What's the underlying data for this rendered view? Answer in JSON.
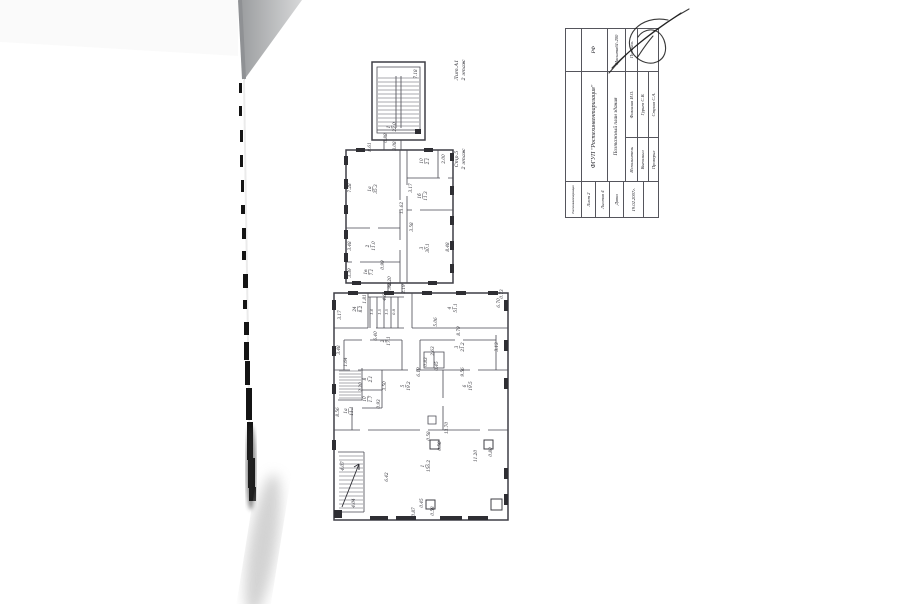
{
  "colors": {
    "wall": "#3f3f46",
    "ink": "#2c2c33",
    "paper": "#ffffff",
    "corner_shadow": "#c2c4c6"
  },
  "titleblock": {
    "org_small": "Ростехинвентаризация",
    "org": "ФГУП \"Ростехинвентаризация\"",
    "doc_title": "Поэтажный план здания",
    "rf": "РФ",
    "scale_label": "Масштаб",
    "scale_value": "1:200",
    "sign_label": "Подпись",
    "sheet": "Лист 2",
    "sheets": "Листов 4",
    "date_label": "Дата",
    "date_value": "19.02.2007г.",
    "col_role": "Исполнитель",
    "col_name": "Фамилия И.О.",
    "rows": [
      {
        "role": "Выполнил",
        "name": "Гурьев С.В."
      },
      {
        "role": "Проверил",
        "name": "Стуков С.А."
      }
    ]
  },
  "plan": {
    "texts": [
      {
        "t": "Лит.А1",
        "x": 458,
        "y": 70,
        "s": 5,
        "n": "section-label"
      },
      {
        "t": "2 этаж",
        "x": 465,
        "y": 70,
        "s": 5,
        "n": "section-label"
      },
      {
        "t": "Стр.5",
        "x": 458,
        "y": 159,
        "s": 5,
        "n": "section-label"
      },
      {
        "t": "2 этаж",
        "x": 465,
        "y": 159,
        "s": 5,
        "n": "section-label"
      },
      {
        "t": "7.18",
        "x": 417,
        "y": 74
      },
      {
        "t": "1",
        "x": 390,
        "y": 127,
        "u": 1
      },
      {
        "t": "22.0",
        "x": 396,
        "y": 127
      },
      {
        "t": "0.88",
        "x": 387,
        "y": 138
      },
      {
        "t": "3.08",
        "x": 396,
        "y": 146
      },
      {
        "t": "8.61",
        "x": 371,
        "y": 147
      },
      {
        "t": "1а",
        "x": 371,
        "y": 189,
        "u": 1
      },
      {
        "t": "35.3",
        "x": 377,
        "y": 189
      },
      {
        "t": "7.28",
        "x": 351,
        "y": 188
      },
      {
        "t": "13.62",
        "x": 403,
        "y": 208
      },
      {
        "t": "10",
        "x": 423,
        "y": 161,
        "u": 1
      },
      {
        "t": "2.1",
        "x": 429,
        "y": 161
      },
      {
        "t": "2.00",
        "x": 445,
        "y": 159
      },
      {
        "t": "3.17",
        "x": 412,
        "y": 188
      },
      {
        "t": "1б",
        "x": 421,
        "y": 196,
        "u": 1
      },
      {
        "t": "11.3",
        "x": 427,
        "y": 196
      },
      {
        "t": "3.58",
        "x": 413,
        "y": 227
      },
      {
        "t": "3",
        "x": 423,
        "y": 248,
        "u": 1
      },
      {
        "t": "30.1",
        "x": 429,
        "y": 248
      },
      {
        "t": "8.48",
        "x": 449,
        "y": 247
      },
      {
        "t": "2",
        "x": 369,
        "y": 246,
        "u": 1
      },
      {
        "t": "11.0",
        "x": 375,
        "y": 246
      },
      {
        "t": "3.48",
        "x": 351,
        "y": 246
      },
      {
        "t": "1в",
        "x": 367,
        "y": 272,
        "u": 1
      },
      {
        "t": "7.1",
        "x": 373,
        "y": 272
      },
      {
        "t": "3.39",
        "x": 351,
        "y": 273
      },
      {
        "t": "0.99",
        "x": 384,
        "y": 265
      },
      {
        "t": "2.20",
        "x": 391,
        "y": 281
      },
      {
        "t": "1.98",
        "x": 391,
        "y": 288
      },
      {
        "t": "2.19",
        "x": 405,
        "y": 289
      },
      {
        "t": "24",
        "x": 356,
        "y": 309,
        "u": 1
      },
      {
        "t": "8.2",
        "x": 362,
        "y": 309
      },
      {
        "t": "3.17",
        "x": 341,
        "y": 315
      },
      {
        "t": "1.81",
        "x": 366,
        "y": 299
      },
      {
        "t": "4.61",
        "x": 386,
        "y": 296
      },
      {
        "t": "1.6",
        "x": 373,
        "y": 312,
        "s": 3.6
      },
      {
        "t": "1.5",
        "x": 381,
        "y": 312,
        "s": 3.6
      },
      {
        "t": "1.5",
        "x": 388,
        "y": 312,
        "s": 3.6
      },
      {
        "t": "0.8",
        "x": 395,
        "y": 312,
        "s": 3.6
      },
      {
        "t": "4",
        "x": 451,
        "y": 308,
        "u": 1
      },
      {
        "t": "51.1",
        "x": 457,
        "y": 308
      },
      {
        "t": "6.70",
        "x": 500,
        "y": 303
      },
      {
        "t": "0.73",
        "x": 503,
        "y": 294
      },
      {
        "t": "5.06",
        "x": 437,
        "y": 322
      },
      {
        "t": "8.79",
        "x": 460,
        "y": 331
      },
      {
        "t": "2",
        "x": 384,
        "y": 341,
        "u": 1
      },
      {
        "t": "17.1",
        "x": 390,
        "y": 341
      },
      {
        "t": "6.40",
        "x": 377,
        "y": 336
      },
      {
        "t": "3.48",
        "x": 340,
        "y": 350
      },
      {
        "t": "1.64",
        "x": 347,
        "y": 362
      },
      {
        "t": "3",
        "x": 458,
        "y": 347,
        "u": 1
      },
      {
        "t": "21.2",
        "x": 464,
        "y": 347
      },
      {
        "t": "3.13",
        "x": 498,
        "y": 347
      },
      {
        "t": "2.63",
        "x": 434,
        "y": 351
      },
      {
        "t": "0.83",
        "x": 427,
        "y": 362
      },
      {
        "t": "0.45",
        "x": 438,
        "y": 366
      },
      {
        "t": "8",
        "x": 366,
        "y": 379,
        "u": 1
      },
      {
        "t": "2.1",
        "x": 372,
        "y": 379
      },
      {
        "t": "2.20",
        "x": 362,
        "y": 387
      },
      {
        "t": "10",
        "x": 366,
        "y": 399,
        "u": 1
      },
      {
        "t": "1.7",
        "x": 372,
        "y": 399
      },
      {
        "t": "0.93",
        "x": 380,
        "y": 404
      },
      {
        "t": "3.50",
        "x": 386,
        "y": 386
      },
      {
        "t": "5",
        "x": 404,
        "y": 386,
        "u": 1
      },
      {
        "t": "19.2",
        "x": 410,
        "y": 386
      },
      {
        "t": "6.19",
        "x": 420,
        "y": 372
      },
      {
        "t": "9.56",
        "x": 464,
        "y": 372
      },
      {
        "t": "6",
        "x": 466,
        "y": 386,
        "u": 1
      },
      {
        "t": "19.5",
        "x": 472,
        "y": 386
      },
      {
        "t": "1а",
        "x": 347,
        "y": 411,
        "u": 1
      },
      {
        "t": "11.1",
        "x": 353,
        "y": 411
      },
      {
        "t": "8.56",
        "x": 339,
        "y": 412
      },
      {
        "t": "13.70",
        "x": 448,
        "y": 428
      },
      {
        "t": "1",
        "x": 424,
        "y": 466,
        "u": 1
      },
      {
        "t": "156.2",
        "x": 430,
        "y": 466
      },
      {
        "t": "6.42",
        "x": 388,
        "y": 477
      },
      {
        "t": "11.20",
        "x": 477,
        "y": 456
      },
      {
        "t": "0.58",
        "x": 441,
        "y": 446
      },
      {
        "t": "0.58",
        "x": 430,
        "y": 436
      },
      {
        "t": "0.80",
        "x": 492,
        "y": 452
      },
      {
        "t": "0.45",
        "x": 423,
        "y": 503
      },
      {
        "t": "0.58",
        "x": 434,
        "y": 511
      },
      {
        "t": "0.87",
        "x": 415,
        "y": 512
      },
      {
        "t": "4.04",
        "x": 355,
        "y": 503
      },
      {
        "t": "4.07",
        "x": 344,
        "y": 466
      }
    ]
  }
}
